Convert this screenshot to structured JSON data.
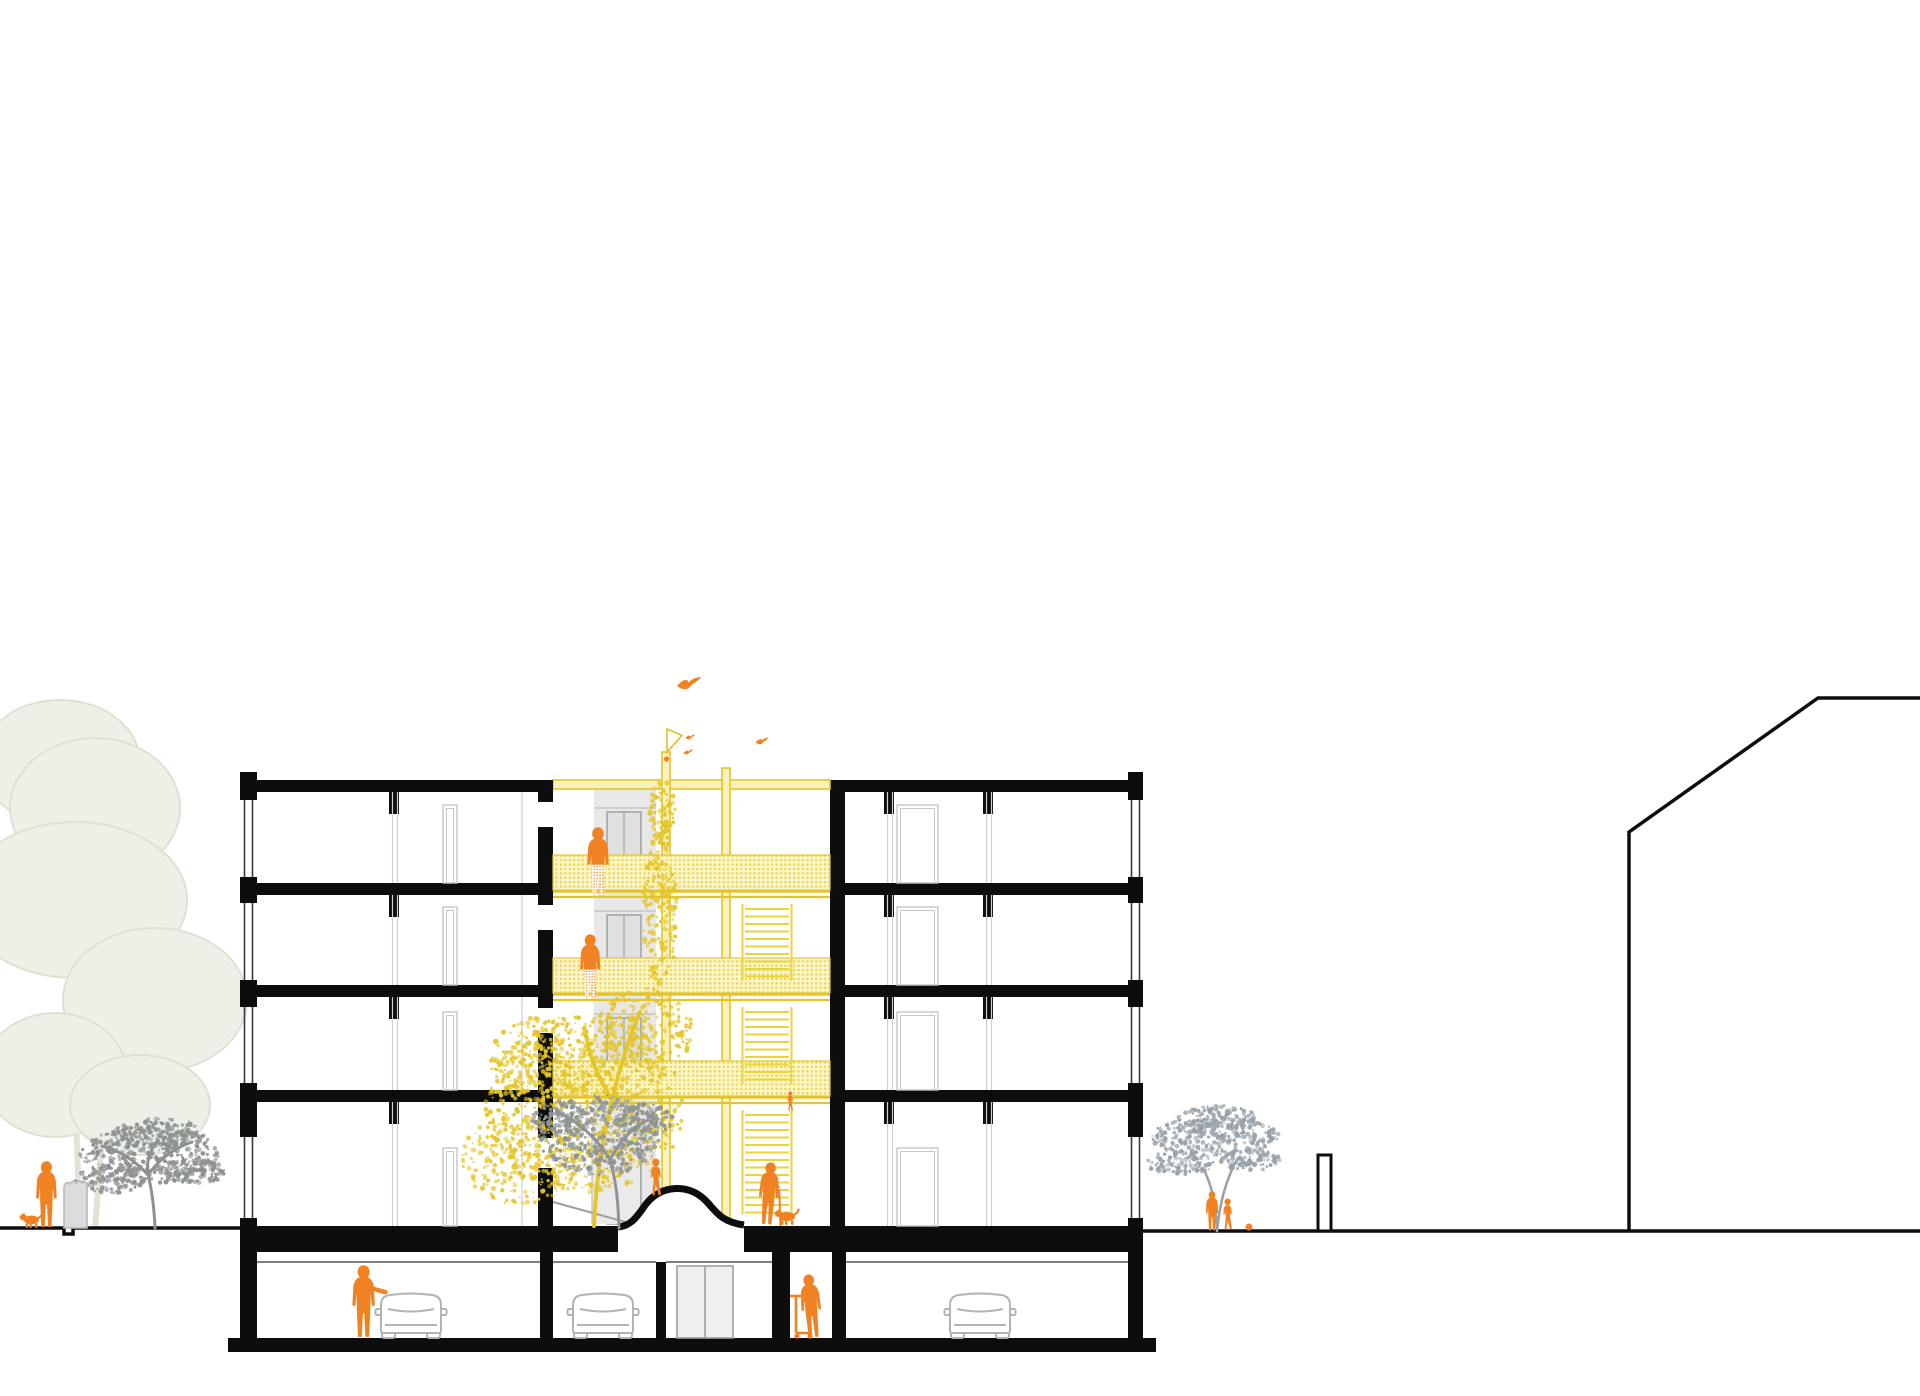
{
  "scene": {
    "title": "Building cross-section drawing",
    "subtitle": "Sectional elevation of a four-storey residential block with a central courtyard atrium, access walkways and an underground parking garage",
    "floors_above_ground": 4,
    "underground_levels": 1,
    "people_count": 10,
    "dog_count": 2,
    "bird_count": 4,
    "car_count": 3,
    "tree_count": 5
  },
  "colors": {
    "background": "#ffffff",
    "structure_black": "#0d0d0d",
    "accent_orange": "#f08224",
    "atrium_yellow": "#e2c52e",
    "atrium_yellow_pale": "#fdf6cd",
    "atrium_mesh_dot": "#ecd23f",
    "stair_yellow": "#ecd23c",
    "yellow_tree": "#e4c62b",
    "gray_tree": "#8e9494",
    "right_tree_gray": "#98a1a8",
    "street_tree_gray": "#8c9190",
    "faded_tree_fill": "#edf0e7",
    "faded_tree_stroke": "#dde1d2",
    "shaft_gray": "#e8e8e8",
    "door_gray": "#e0e0e0",
    "door_outline": "#9f9f9f",
    "frame_gray": "#c6c6c6",
    "thin_line": "#cfcfcf",
    "car_outline": "#b3b3b3",
    "bin_fill": "#dcdcdc",
    "bin_outline": "#b9b9b9",
    "ramp_gray": "#eaeaea",
    "ramp_edge": "#9d9d9d"
  },
  "people": [
    {
      "name": "resident-on-walkway-level3",
      "kind": "adult",
      "x": 584,
      "feet": 897,
      "h": 70,
      "dotted_legs": true
    },
    {
      "name": "resident-on-walkway-level2",
      "kind": "adult",
      "x": 577,
      "feet": 1000,
      "h": 66,
      "dotted_legs": true
    },
    {
      "name": "small-child-on-walkway-level1",
      "kind": "child",
      "x": 786,
      "feet": 1112,
      "h": 21
    },
    {
      "name": "child-running-on-mound",
      "kind": "child",
      "x": 648,
      "feet": 1197,
      "h": 39
    },
    {
      "name": "elder-with-cane-courtyard",
      "kind": "adult",
      "x": 754,
      "feet": 1225,
      "h": 63,
      "cane": true,
      "lean": 4
    },
    {
      "name": "person-by-car-basement",
      "kind": "adult",
      "x": 349,
      "feet": 1338,
      "h": 73,
      "arm": true
    },
    {
      "name": "child-with-scooter-basement",
      "kind": "adult",
      "x": 801,
      "feet": 1338,
      "h": 64,
      "lean": -5,
      "flip": true
    },
    {
      "name": "pedestrian-street-left",
      "kind": "adult",
      "x": 33,
      "feet": 1228,
      "h": 67,
      "flip": true
    },
    {
      "name": "adult-under-right-tree",
      "kind": "adult",
      "x": 1204,
      "feet": 1231,
      "h": 40
    },
    {
      "name": "child-under-right-tree",
      "kind": "child",
      "x": 1221,
      "feet": 1231,
      "h": 33
    }
  ],
  "animals": [
    {
      "name": "dog-street-left",
      "x": 19,
      "feet": 1228,
      "scale": 0.95,
      "flip": false
    },
    {
      "name": "dog-beside-elder",
      "x": 774,
      "feet": 1225,
      "scale": 1.0,
      "flip": false
    }
  ],
  "birds": [
    {
      "name": "bird-large",
      "x": 676,
      "y": 676,
      "scale": 1.1
    },
    {
      "name": "bird-small-1",
      "x": 685,
      "y": 734,
      "scale": 0.45
    },
    {
      "name": "bird-small-2",
      "x": 683,
      "y": 749,
      "scale": 0.45
    },
    {
      "name": "bird-small-3",
      "x": 755,
      "y": 737,
      "scale": 0.6
    }
  ],
  "cars": [
    {
      "name": "car-basement-left",
      "x": 375,
      "top": 1289
    },
    {
      "name": "car-basement-center",
      "x": 567,
      "top": 1289
    },
    {
      "name": "car-basement-right",
      "x": 944,
      "top": 1289
    }
  ],
  "objects": {
    "scooter": {
      "x": 796,
      "y_top": 1296,
      "y_deck": 1333
    },
    "ball": {
      "cx": 1249,
      "cy": 1227,
      "r": 3.5
    },
    "bin": {
      "x": 64,
      "top": 1182,
      "w": 23,
      "bottom": 1228
    },
    "pennant": {
      "path": "M667,752 L667,729 L682,735.5 Z"
    },
    "post_marker": {
      "cx": 666.5,
      "cy": 759,
      "r": 2.6
    },
    "boundary_pillar": {
      "x": 1318,
      "y": 1155,
      "w": 13,
      "h": 76
    }
  },
  "neighbor_building": {
    "outline": "1629,1231 1629,832 1818,698 1920,698"
  },
  "trees": [
    {
      "name": "yellow-courtyard-tree",
      "color": "#e4c62b",
      "trunk": "M594,1226 C596,1180 602,1140 612,1100 C618,1075 628,1040 640,1012 M612,1100 C600,1080 590,1060 586,1035",
      "trunk_width": 4,
      "clusters": [
        {
          "cx": 585,
          "cy": 1105,
          "rx": 100,
          "ry": 88,
          "n": 850
        },
        {
          "cx": 545,
          "cy": 1060,
          "rx": 55,
          "ry": 45,
          "n": 260
        },
        {
          "cx": 645,
          "cy": 1030,
          "rx": 48,
          "ry": 42,
          "n": 240
        },
        {
          "cx": 660,
          "cy": 905,
          "rx": 17,
          "ry": 90,
          "n": 230
        },
        {
          "cx": 662,
          "cy": 812,
          "rx": 13,
          "ry": 32,
          "n": 90
        },
        {
          "cx": 520,
          "cy": 1160,
          "rx": 60,
          "ry": 45,
          "n": 260
        }
      ]
    },
    {
      "name": "gray-courtyard-tree",
      "color": "#8e9494",
      "trunk": "M619,1228 C618,1200 616,1180 610,1160 M610,1160 C595,1135 575,1120 558,1112 M610,1160 C620,1140 632,1128 648,1120",
      "trunk_width": 3,
      "clusters": [
        {
          "cx": 600,
          "cy": 1135,
          "rx": 62,
          "ry": 40,
          "n": 420
        },
        {
          "cx": 560,
          "cy": 1118,
          "rx": 30,
          "ry": 18,
          "n": 120
        },
        {
          "cx": 645,
          "cy": 1120,
          "rx": 28,
          "ry": 16,
          "n": 110
        }
      ]
    },
    {
      "name": "street-tree-left",
      "color": "#8c9190",
      "trunk": "M155,1228 C154,1205 152,1190 148,1175 M148,1175 C135,1160 118,1150 102,1146 M148,1175 C160,1158 175,1148 192,1142 M148,1175 C146,1160 150,1150 158,1140",
      "trunk_width": 3,
      "clusters": [
        {
          "cx": 150,
          "cy": 1155,
          "rx": 70,
          "ry": 28,
          "n": 420
        },
        {
          "cx": 110,
          "cy": 1180,
          "rx": 35,
          "ry": 14,
          "n": 130
        },
        {
          "cx": 195,
          "cy": 1172,
          "rx": 30,
          "ry": 12,
          "n": 110
        },
        {
          "cx": 160,
          "cy": 1132,
          "rx": 45,
          "ry": 14,
          "n": 140
        }
      ]
    },
    {
      "name": "street-tree-right",
      "color": "#98a1a8",
      "trunk": "M1217,1231 C1216,1205 1212,1185 1203,1168 M1217,1231 C1220,1200 1228,1175 1238,1158",
      "trunk_width": 2.5,
      "clusters": [
        {
          "cx": 1215,
          "cy": 1137,
          "rx": 64,
          "ry": 20,
          "n": 330
        },
        {
          "cx": 1180,
          "cy": 1163,
          "rx": 34,
          "ry": 12,
          "n": 110
        },
        {
          "cx": 1250,
          "cy": 1160,
          "rx": 30,
          "ry": 11,
          "n": 100
        },
        {
          "cx": 1218,
          "cy": 1117,
          "rx": 40,
          "ry": 12,
          "n": 120
        }
      ]
    }
  ]
}
